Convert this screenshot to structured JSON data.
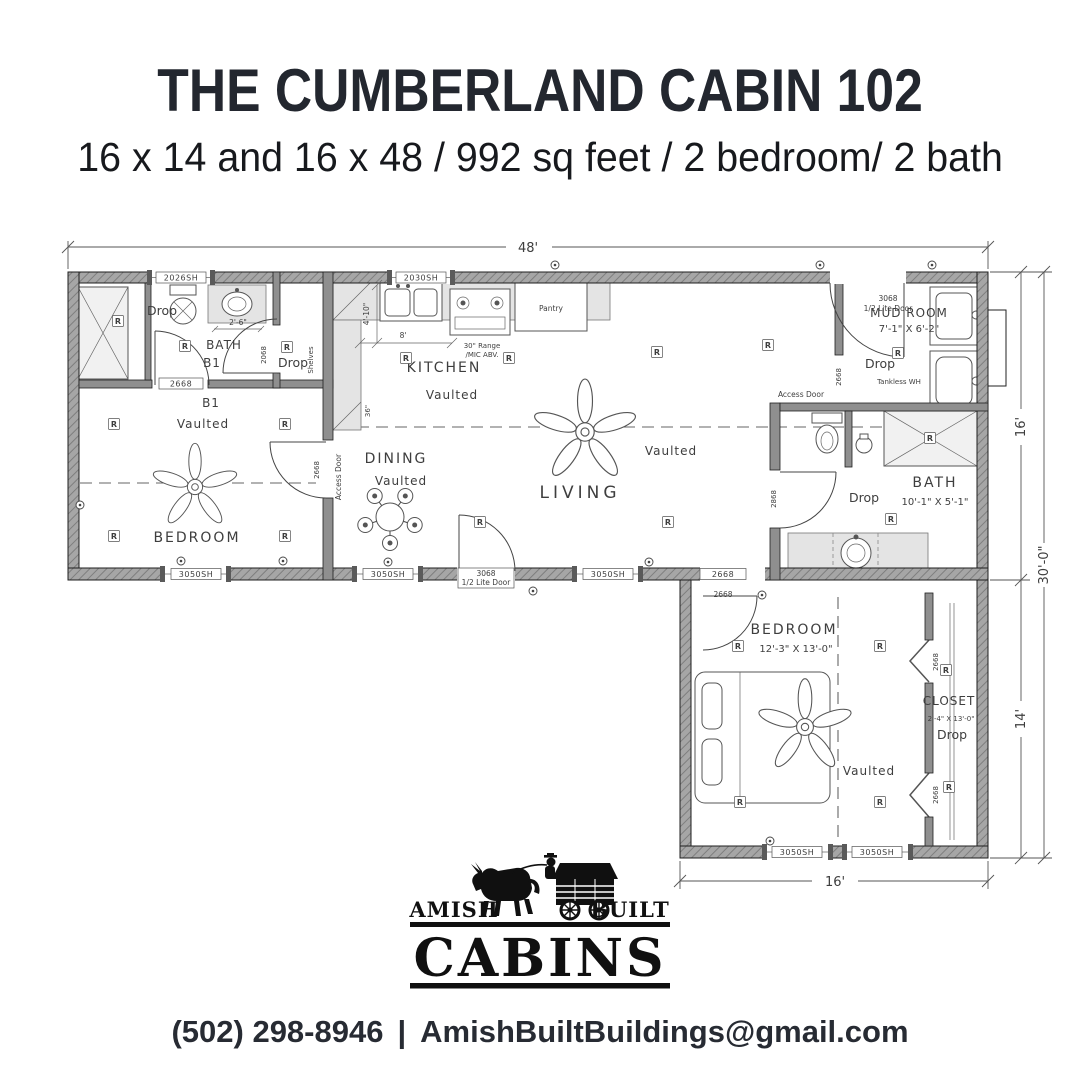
{
  "header": {
    "title": "THE CUMBERLAND CABIN 102",
    "subtitle": "16 x 14 and 16 x 48 / 992 sq feet / 2 bedroom/ 2 bath"
  },
  "plan": {
    "dims": {
      "overall_width": "48'",
      "main_depth": "16'",
      "total_depth": "30'-0\"",
      "lower_depth": "14'",
      "lower_width": "16'"
    },
    "windows": {
      "w2026": "2026SH",
      "w2030": "2030SH",
      "w3050": "3050SH"
    },
    "doors": {
      "front_code": "3068",
      "front_type": "1/2 Lite Door",
      "d2668": "2668",
      "d2068": "2068",
      "d2868": "2868"
    },
    "rooms": {
      "bath1_line1": "BATH",
      "bath1_line2": "B1",
      "b1": "B1",
      "vaulted": "Vaulted",
      "bedroom1": "BEDROOM",
      "kitchen": "KITCHEN",
      "dining": "DINING",
      "living": "LIVING",
      "mudroom": "MUD ROOM",
      "mudroom_size": "7'-1\" X 6'-2\"",
      "bath2": "BATH",
      "bath2_size": "10'-1\" X 5'-1\"",
      "bedroom2": "BEDROOM",
      "bedroom2_size": "12'-3\" X 13'-0\"",
      "closet": "CLOSET",
      "closet_size": "2'-4\" X 13'-0\""
    },
    "notes": {
      "drop": "Drop",
      "access_door": "Access Door",
      "shelves": "Shelves",
      "tankless": "Tankless WH",
      "pantry": "Pantry",
      "range1": "30\" Range",
      "range2": "/MIC ABV.",
      "receptacle": "R"
    },
    "small_dims": {
      "vanity": "2'-6\"",
      "kitchen_w": "8'",
      "kitchen_d": "4'-10\"",
      "peninsula": "36\""
    }
  },
  "logo": {
    "left": "AMISH",
    "right": "BUILT",
    "main": "CABINS"
  },
  "footer": {
    "phone": "(502) 298-8946",
    "divider": "|",
    "email": "AmishBuiltBuildings@gmail.com"
  }
}
